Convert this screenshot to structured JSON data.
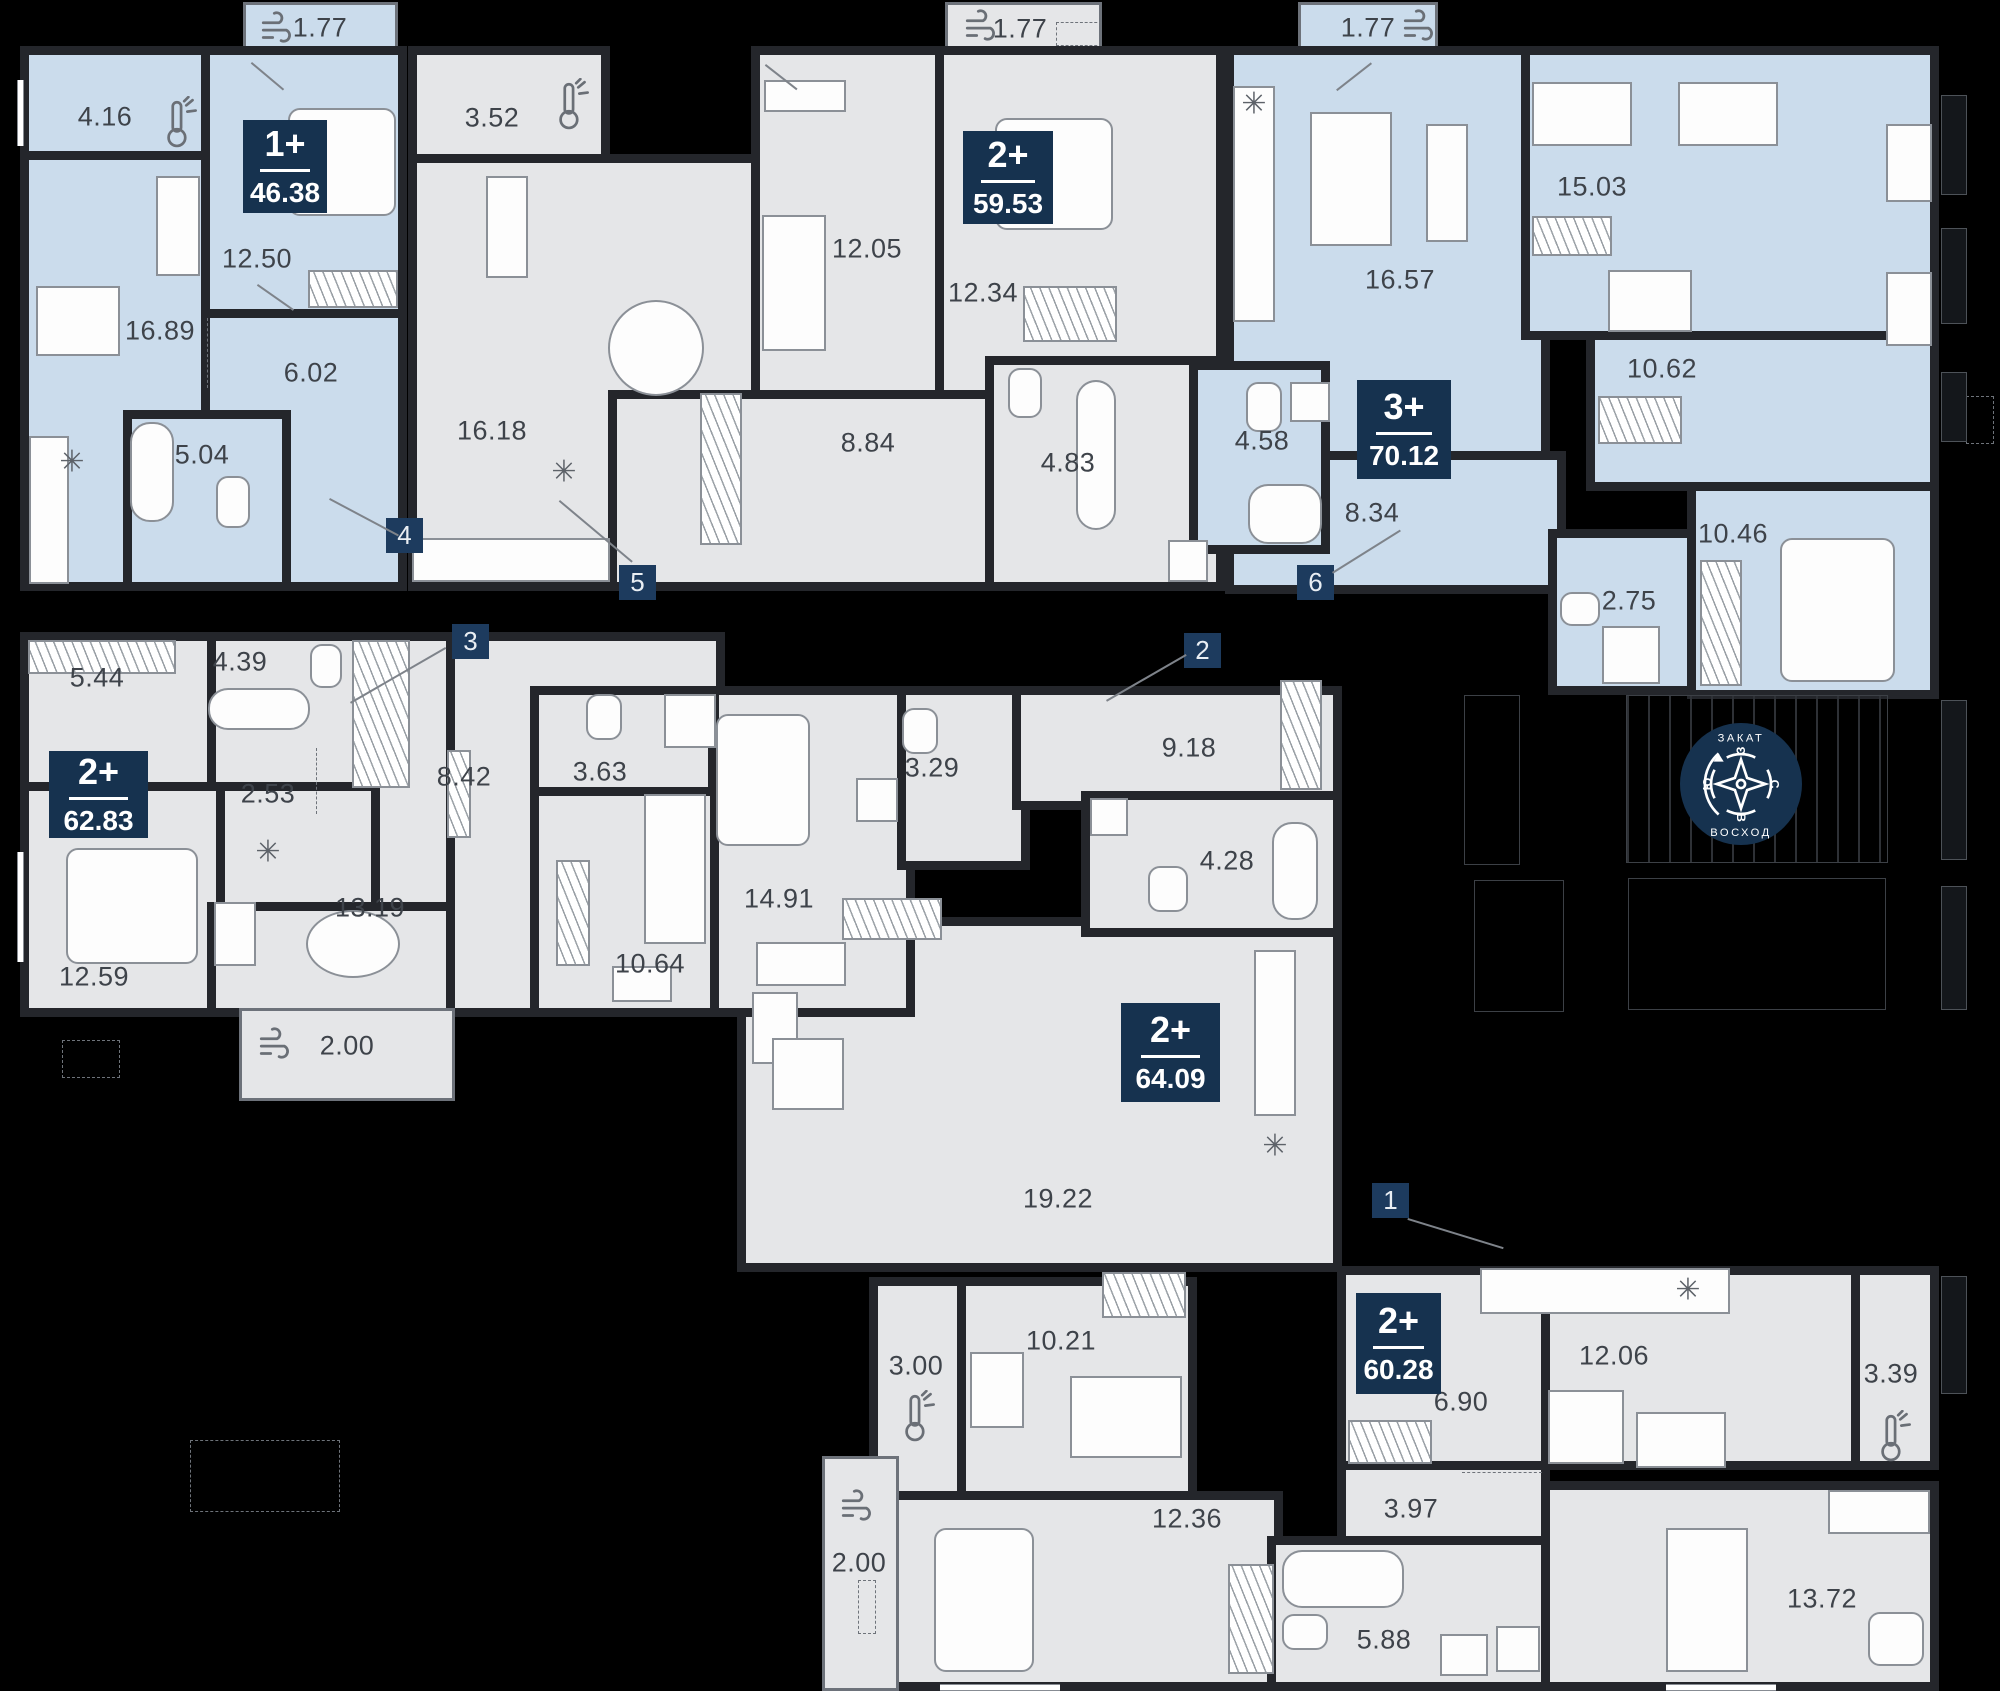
{
  "compass": {
    "sunset": "ЗАКАТ",
    "sunrise": "ВОСХОД",
    "north": "С",
    "east": "В",
    "south": "Ю",
    "west": "З"
  },
  "icons": {
    "fridge": "✳"
  },
  "colors": {
    "background": "#000000",
    "wall": "#24262b",
    "apartment_blue": "#cbdcec",
    "apartment_gray": "#e5e6e8",
    "badge_navy": "#16324f",
    "label_gray": "#3e434a"
  },
  "apartments": [
    {
      "badge": "4",
      "type": "1+",
      "area": "46.38",
      "rooms": [
        "1.77",
        "4.16",
        "12.50",
        "16.89",
        "6.02",
        "5.04"
      ]
    },
    {
      "badge": "5",
      "type": "2+",
      "area": "59.53",
      "rooms": [
        "1.77",
        "3.52",
        "12.05",
        "12.34",
        "8.84",
        "16.18",
        "4.83"
      ]
    },
    {
      "badge": "6",
      "type": "3+",
      "area": "70.12",
      "rooms": [
        "1.77",
        "16.57",
        "15.03",
        "10.62",
        "4.58",
        "8.34",
        "2.75",
        "10.46"
      ]
    },
    {
      "badge": "3",
      "type": "2+",
      "area": "62.83",
      "rooms": [
        "5.44",
        "4.39",
        "2.53",
        "12.59",
        "13.19",
        "2.00",
        "8.42",
        "3.63",
        "10.64"
      ]
    },
    {
      "badge": "2",
      "type": "2+",
      "area": "64.09",
      "rooms": [
        "14.91",
        "3.29",
        "9.18",
        "4.28",
        "19.22",
        "10.21",
        "3.00"
      ]
    },
    {
      "badge": "1",
      "type": "2+",
      "area": "60.28",
      "rooms": [
        "6.90",
        "12.06",
        "3.39",
        "3.97",
        "5.88",
        "13.72",
        "12.36",
        "2.00"
      ]
    }
  ]
}
